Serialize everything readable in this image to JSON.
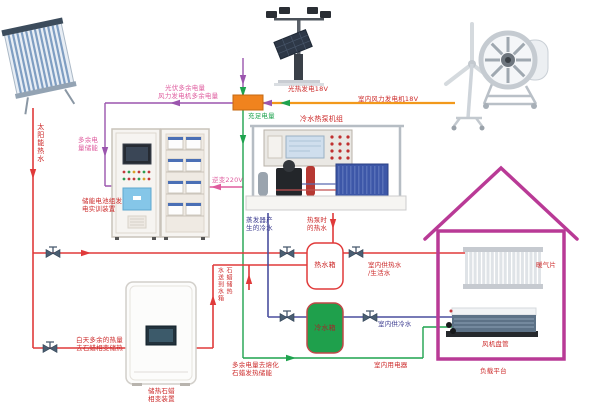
{
  "colors": {
    "power_main": "#f2991b",
    "power_surplus_purple": "#9b55ae",
    "power_magenta": "#df5b9e",
    "power_ok_green": "#1ea34e",
    "hot_water_red": "#e03a3a",
    "cold_water_blue": "#4a4f9e",
    "house_outline": "#b93a96",
    "junction_box": "#f0831e",
    "cold_tank_fill": "#1fa04c",
    "label_red": "#cc2a2a",
    "label_pink": "#df5b9e",
    "label_green": "#1ea34e",
    "label_blue": "#3c3c90"
  },
  "labels": {
    "pv_surplus": "光伏多余电量",
    "wind_surplus": "风力发电机多余电量",
    "solar_thermal_gen": "光热发电18V",
    "indoor_wind_gen": "室内风力发电机18V",
    "sufficient_power": "充足电量",
    "surplus_storage": {
      "line1": "多余电",
      "line2": "量储能"
    },
    "inverter": "逆变220V",
    "battery_cabinet": {
      "line1": "储能电池组发",
      "line2": "电实训装置"
    },
    "solar_hot_water": "太阳能热水",
    "heat_pump_unit": "冷水热泵机组",
    "evap_cold": {
      "line1": "蒸发器产",
      "line2": "生的冷水"
    },
    "hp_hot": {
      "line1": "热泵时",
      "line2": "的热水"
    },
    "hot_tank": "热水箱",
    "cold_tank": "冷水箱",
    "paraffin_to_tank": {
      "col_left": "水送到水箱",
      "col_right": "石蜡储热"
    },
    "melt_paraffin": {
      "line1": "多余电量去熔化",
      "line2": "石蜡发热储能"
    },
    "paraffin_device": {
      "line1": "储热石蜡",
      "line2": "相变装置"
    },
    "day_surplus": {
      "line1": "白天多余的热量",
      "line2": "去石蜡相变储热"
    },
    "indoor_hot": {
      "line1": "室内供热水",
      "line2": "/生活水"
    },
    "indoor_cold": "室内供冷水",
    "indoor_appliance": "室内用电器",
    "radiator": "暖气片",
    "fan_coil": "风机盘管",
    "load_platform": "负载平台"
  }
}
